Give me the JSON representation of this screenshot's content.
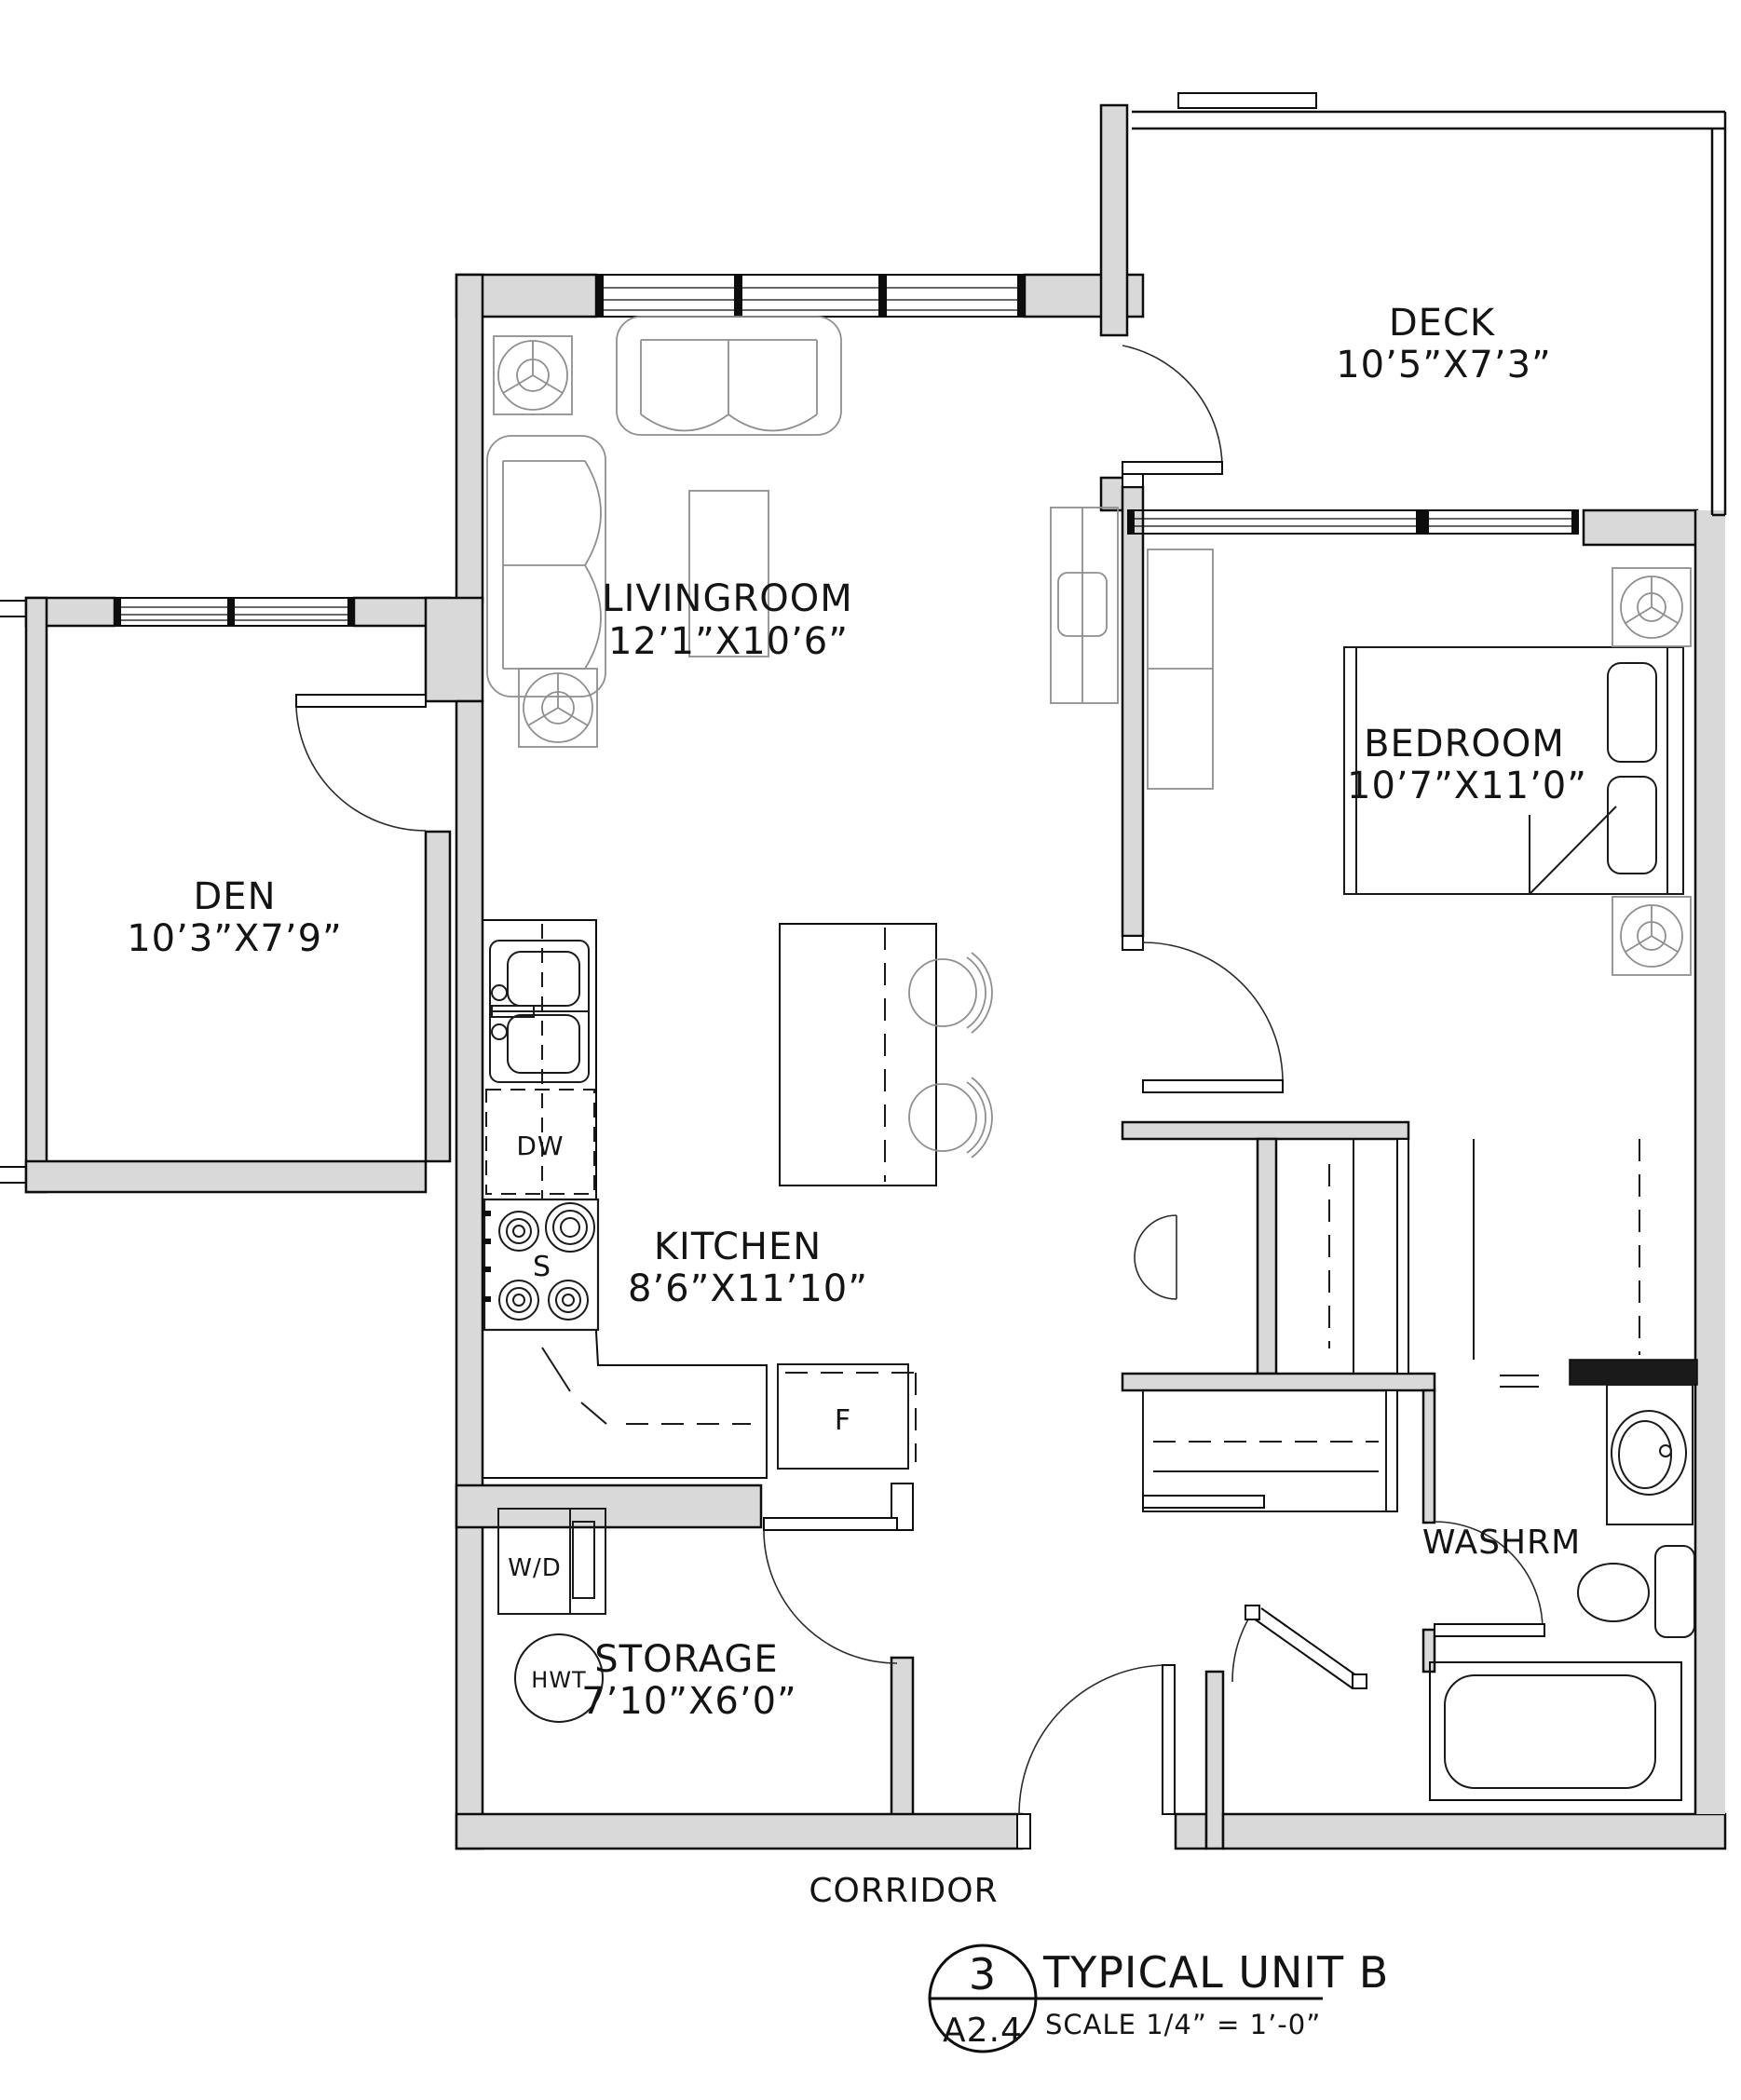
{
  "drawing": {
    "type": "architectural-floor-plan",
    "title_block": {
      "detail_number": "3",
      "sheet_ref": "A2.4",
      "title": "TYPICAL UNIT B",
      "scale_label": "SCALE  1/4” = 1’-0”"
    },
    "rooms": [
      {
        "id": "deck",
        "name": "DECK",
        "dims": "10’5”X7’3”"
      },
      {
        "id": "livingroom",
        "name": "LIVINGROOM",
        "dims": "12’1”X10’6”"
      },
      {
        "id": "bedroom",
        "name": "BEDROOM",
        "dims": "10’7”X11’0”"
      },
      {
        "id": "den",
        "name": "DEN",
        "dims": "10’3”X7’9”"
      },
      {
        "id": "kitchen",
        "name": "KITCHEN",
        "dims": "8’6”X11’10”"
      },
      {
        "id": "storage",
        "name": "STORAGE",
        "dims": "7’10”X6’0”"
      },
      {
        "id": "washroom",
        "name": "WASHRM",
        "dims": ""
      },
      {
        "id": "corridor",
        "name": "CORRIDOR",
        "dims": ""
      }
    ],
    "fixture_labels": {
      "dishwasher": "DW",
      "stove": "S",
      "fridge": "F",
      "washer_dryer": "W/D",
      "hot_water_tank": "HWT"
    },
    "colors": {
      "background": "#ffffff",
      "wall_poche": "#d9d9d9",
      "wall_line": "#0d0d0d",
      "fixture_line": "#1a1a1a",
      "furniture_line": "#8f8f8f"
    }
  }
}
